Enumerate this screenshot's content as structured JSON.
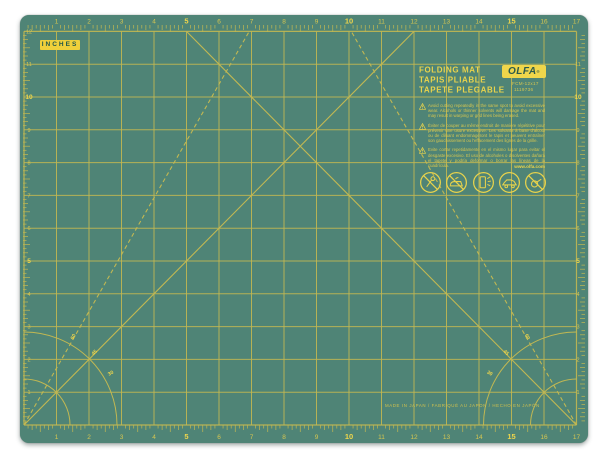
{
  "product": {
    "brand_logo": "OLFA",
    "registered_mark": "®",
    "model": "FCM-12x17",
    "item_number": "1119736",
    "unit_label": "INCHES",
    "titles": [
      "FOLDING MAT",
      "TAPIS PLIABLE",
      "TAPETE PLEGABLE"
    ],
    "warnings": [
      {
        "lang": "en",
        "text": "Avoid cutting repeatedly in the same spot to avoid excessive wear. Alcohols or thinner solvents will damage the mat and may result in warping or grid lines being erased."
      },
      {
        "lang": "fr",
        "text": "Éviter de couper au même endroit de manière répétitive pour prévenir une usure excessive. Les solvants à base d'alcool ou de diluant endommageront le tapis et peuvent entraîner son gauchissement ou l'effacement des lignes de la grille."
      },
      {
        "lang": "es",
        "text": "Evite cortar repetidamente en el mismo lugar para evitar el desgaste excesivo. El uso de alcoholes o disolventes dañará el tapete y podría deformar o borrar las líneas de la cuadrícula."
      }
    ],
    "website": "www.olfa.com",
    "made_in": "MADE IN JAPAN / FABRIQUÉ AU JAPON / HECHO EN JAPÓN",
    "warning_symbol": "!",
    "care_icon_names": [
      "no-pins-icon",
      "no-iron-icon",
      "sunlight-warning-icon",
      "hot-car-warning-icon",
      "no-heat-source-icon"
    ]
  },
  "rulers": {
    "top": [
      "1",
      "2",
      "3",
      "4",
      "5",
      "6",
      "7",
      "8",
      "9",
      "10",
      "11",
      "12",
      "13",
      "14",
      "15",
      "16",
      "17"
    ],
    "bottom": [
      "1",
      "2",
      "3",
      "4",
      "5",
      "6",
      "7",
      "8",
      "9",
      "10",
      "11",
      "12",
      "13",
      "14",
      "15",
      "16",
      "17"
    ],
    "left": [
      "12",
      "11",
      "10",
      "9",
      "8",
      "7",
      "6",
      "5",
      "4",
      "3",
      "2",
      "1"
    ],
    "right": [
      "11",
      "10",
      "9",
      "8",
      "7",
      "6",
      "5",
      "4",
      "3",
      "2",
      "1"
    ],
    "bold_top_bottom": [
      "5",
      "10",
      "15"
    ],
    "bold_left_right": [
      "5",
      "10"
    ],
    "angle_labels": [
      "30",
      "45",
      "60"
    ]
  },
  "colors": {
    "mat_green": "#4f8476",
    "grid_yellow": "#c2b852",
    "bright_yellow": "#efd64b",
    "dim_yellow": "#d6c650",
    "label_box_yellow": "#efd03b",
    "label_text_green": "#23584a"
  }
}
